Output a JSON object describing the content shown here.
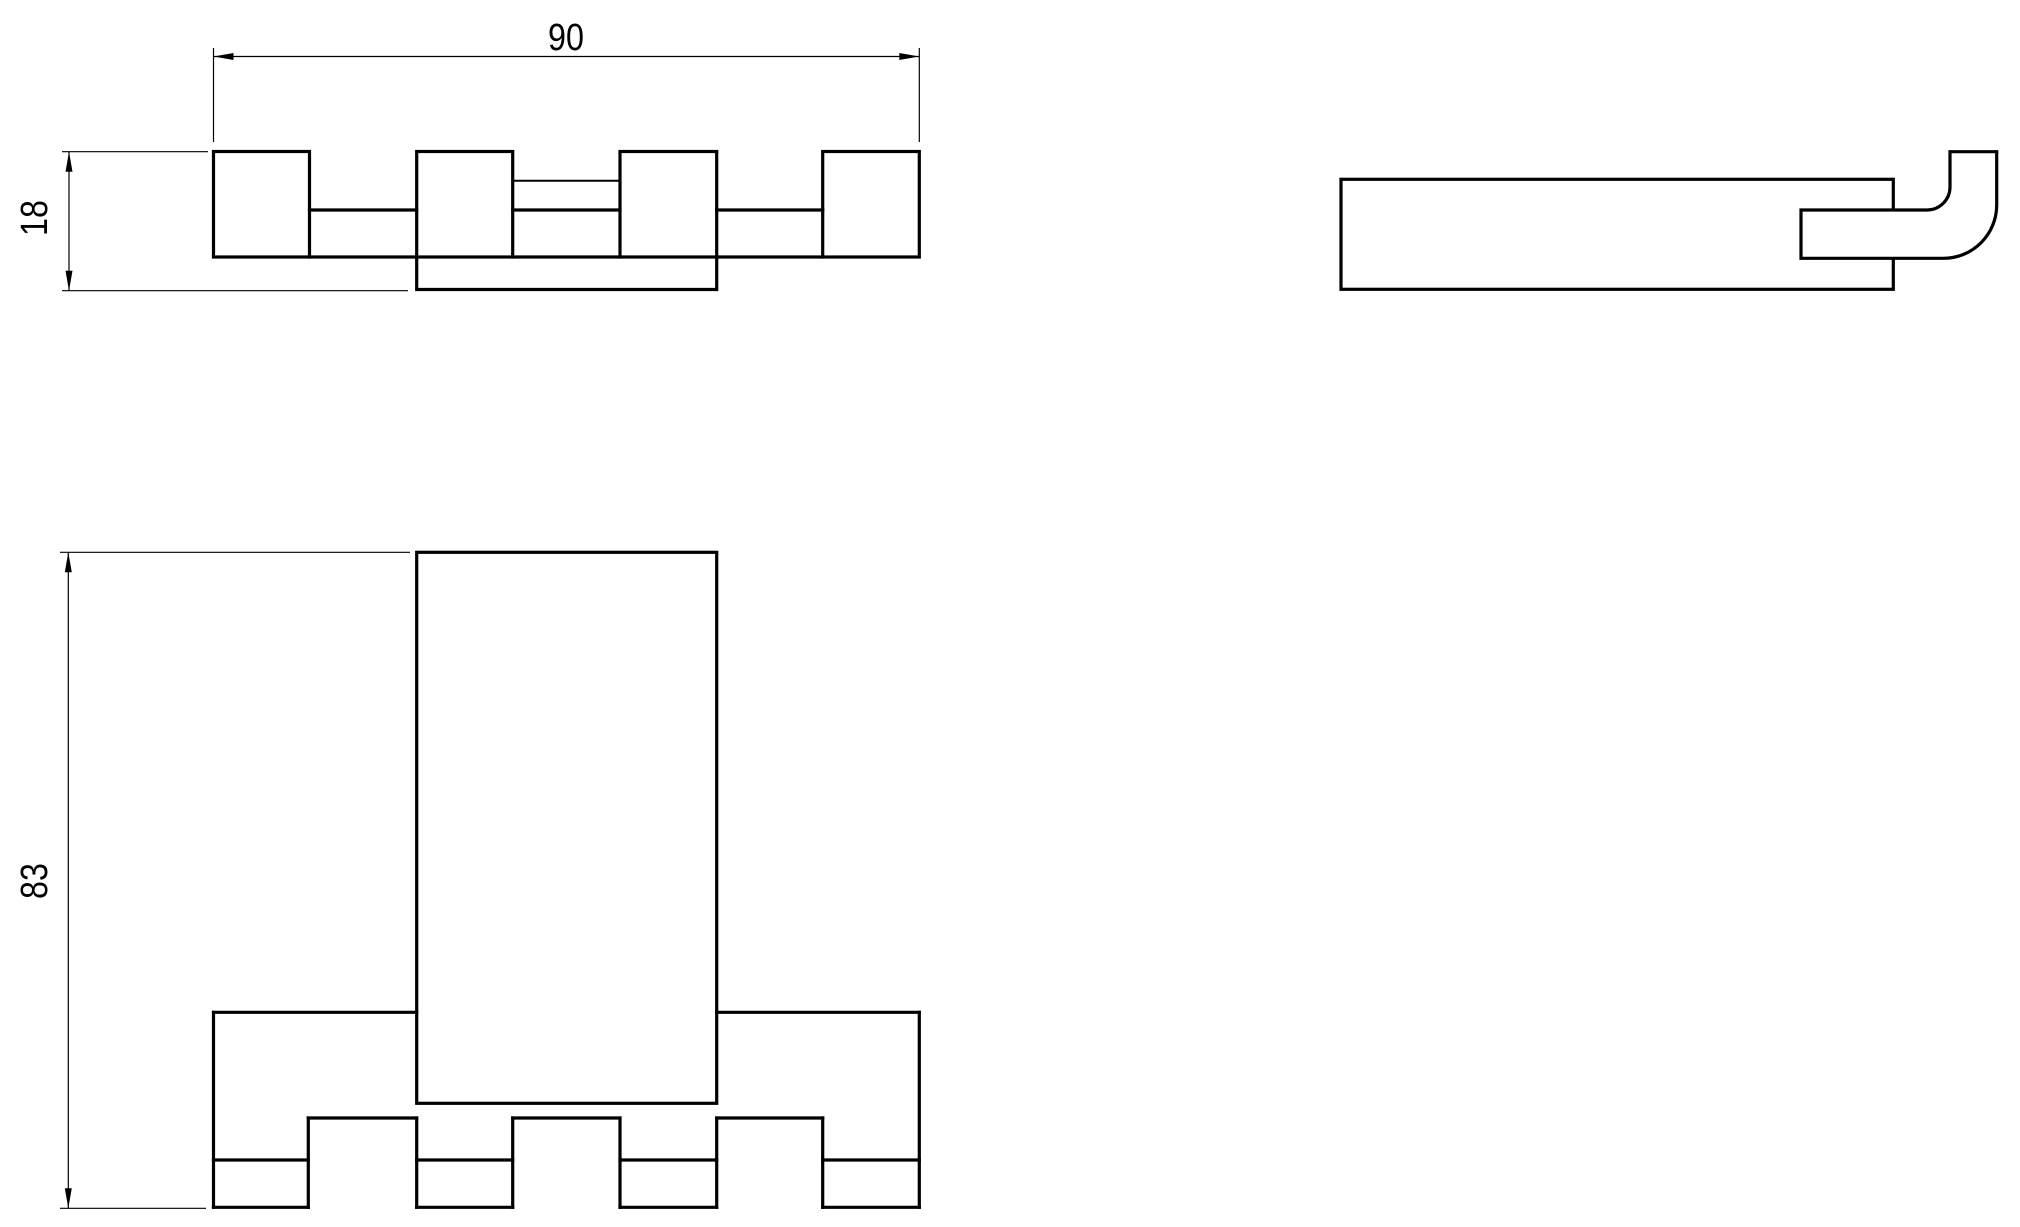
{
  "drawing": {
    "type": "orthographic-technical-drawing",
    "background_color": "#ffffff",
    "line_color": "#000000",
    "views": [
      {
        "id": "top-view",
        "label": "top view"
      },
      {
        "id": "front-view",
        "label": "front view"
      },
      {
        "id": "side-view",
        "label": "side view"
      }
    ],
    "dimensions": {
      "width": {
        "value": "90",
        "orientation": "horizontal",
        "view": "top-view"
      },
      "depth": {
        "value": "18",
        "orientation": "vertical",
        "view": "top-view"
      },
      "height": {
        "value": "83",
        "orientation": "vertical",
        "view": "front-view"
      }
    }
  }
}
